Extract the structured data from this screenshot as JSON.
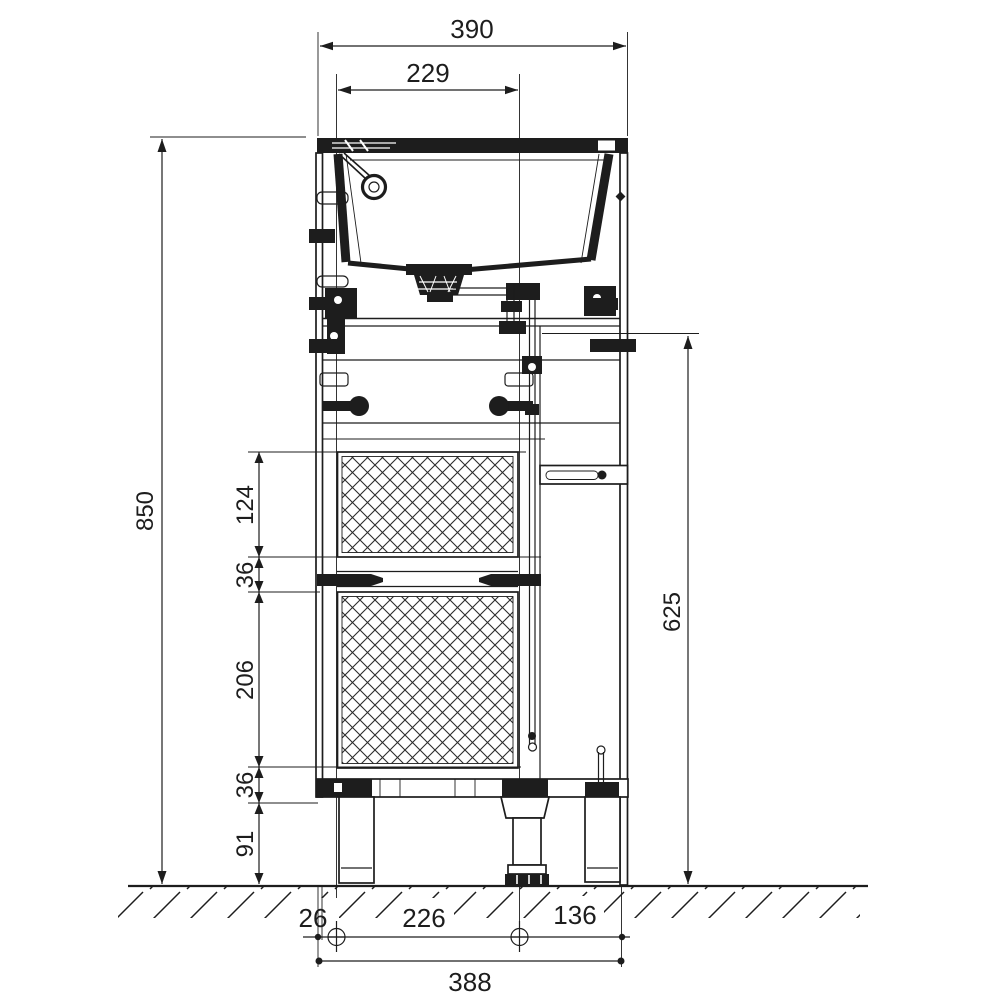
{
  "drawing": {
    "background": "#ffffff",
    "ink": "#1d1d1d",
    "dims": {
      "overall_width": "390",
      "basin_cutout_width": "229",
      "overall_height": "850",
      "upper_front_height": "124",
      "upper_gap": "36",
      "lower_front_height": "206",
      "lower_gap": "36",
      "foot_height": "91",
      "carcase_side_height": "625",
      "front_offset": "26",
      "fixing_span": "226",
      "rear_span": "136",
      "base_overall_width": "388"
    }
  }
}
